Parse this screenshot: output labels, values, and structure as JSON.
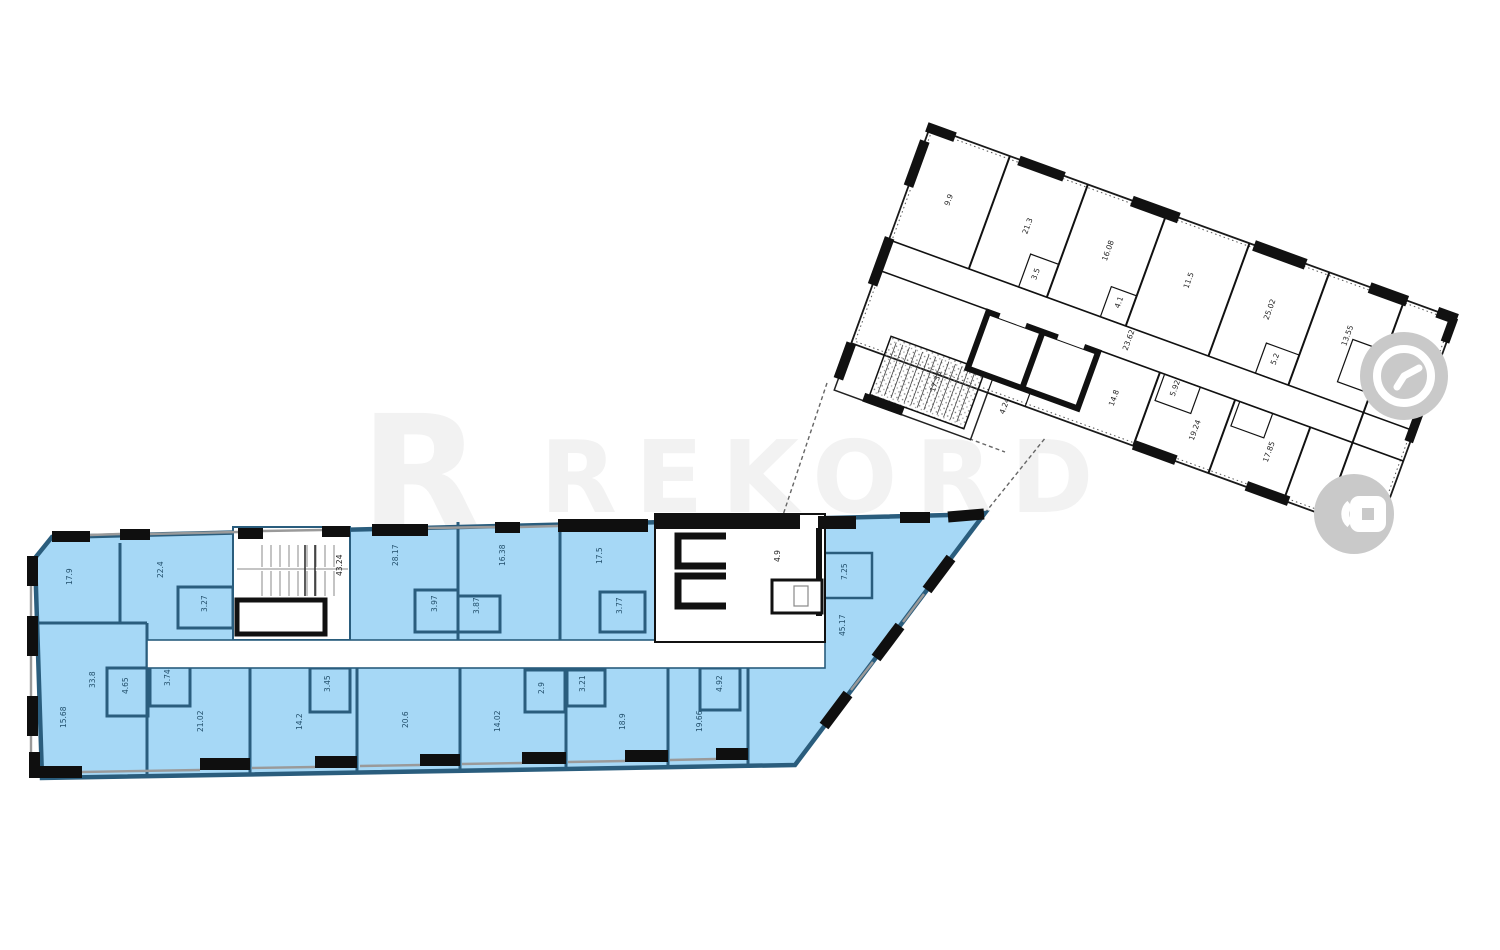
{
  "watermark": {
    "logo_letter": "R",
    "text": "REKORD",
    "color": "#f2f2f2"
  },
  "icons": {
    "clock": {
      "name": "clock-icon",
      "bg_color": "#c9c9c9",
      "glyph_color": "#ffffff"
    },
    "lock": {
      "name": "lock-icon",
      "bg_color": "#c9c9c9",
      "glyph_color": "#ffffff"
    }
  },
  "colors": {
    "highlight_fill": "#a6d8f6",
    "highlight_wall": "#2a5d7d",
    "plan_wall": "#111111",
    "window_line": "#9a9a9a",
    "background": "#ffffff"
  },
  "blue_wing": {
    "name": "highlighted-section-plan",
    "stair_label": "43.24",
    "labels": [
      {
        "t": "17.9",
        "x": 72,
        "y": 585
      },
      {
        "t": "22.4",
        "x": 163,
        "y": 578
      },
      {
        "t": "3.27",
        "x": 207,
        "y": 612
      },
      {
        "t": "43.24",
        "x": 342,
        "y": 576,
        "dark": true
      },
      {
        "t": "28.17",
        "x": 398,
        "y": 566
      },
      {
        "t": "16.38",
        "x": 505,
        "y": 566
      },
      {
        "t": "17.5",
        "x": 602,
        "y": 564
      },
      {
        "t": "3.97",
        "x": 437,
        "y": 612
      },
      {
        "t": "3.87",
        "x": 479,
        "y": 614
      },
      {
        "t": "3.77",
        "x": 622,
        "y": 614
      },
      {
        "t": "4.9",
        "x": 780,
        "y": 562,
        "dark": true
      },
      {
        "t": "7.25",
        "x": 847,
        "y": 580
      },
      {
        "t": "45.17",
        "x": 845,
        "y": 636
      },
      {
        "t": "33.8",
        "x": 95,
        "y": 688
      },
      {
        "t": "15.68",
        "x": 66,
        "y": 728
      },
      {
        "t": "4.65",
        "x": 128,
        "y": 694
      },
      {
        "t": "3.74",
        "x": 170,
        "y": 686
      },
      {
        "t": "21.02",
        "x": 203,
        "y": 732
      },
      {
        "t": "14.2",
        "x": 302,
        "y": 730
      },
      {
        "t": "3.45",
        "x": 330,
        "y": 692
      },
      {
        "t": "20.6",
        "x": 408,
        "y": 728
      },
      {
        "t": "14.02",
        "x": 500,
        "y": 732
      },
      {
        "t": "2.9",
        "x": 544,
        "y": 694
      },
      {
        "t": "3.21",
        "x": 585,
        "y": 692
      },
      {
        "t": "18.9",
        "x": 625,
        "y": 730
      },
      {
        "t": "19.66",
        "x": 702,
        "y": 732
      },
      {
        "t": "4.92",
        "x": 722,
        "y": 692
      }
    ]
  },
  "white_wing": {
    "name": "adjacent-section-plan",
    "labels": [
      {
        "t": "9.9",
        "x": 45,
        "y": 68
      },
      {
        "t": "21.3",
        "x": 128,
        "y": 68
      },
      {
        "t": "16.08",
        "x": 212,
        "y": 66
      },
      {
        "t": "11.5",
        "x": 298,
        "y": 64
      },
      {
        "t": "25.02",
        "x": 384,
        "y": 66
      },
      {
        "t": "13.55",
        "x": 466,
        "y": 64
      },
      {
        "t": "18.2",
        "x": 534,
        "y": 84
      },
      {
        "t": "3.5",
        "x": 152,
        "y": 108
      },
      {
        "t": "4.1",
        "x": 240,
        "y": 106
      },
      {
        "t": "5.2",
        "x": 406,
        "y": 106
      },
      {
        "t": "23.62",
        "x": 262,
        "y": 143
      },
      {
        "t": "5.92",
        "x": 322,
        "y": 170
      },
      {
        "t": "14.8",
        "x": 268,
        "y": 200
      },
      {
        "t": "19.24",
        "x": 355,
        "y": 205
      },
      {
        "t": "17.85",
        "x": 432,
        "y": 200
      },
      {
        "t": "16.7",
        "x": 524,
        "y": 198
      },
      {
        "t": "17.35",
        "x": 95,
        "y": 248
      },
      {
        "t": "4.24",
        "x": 168,
        "y": 245
      }
    ]
  }
}
